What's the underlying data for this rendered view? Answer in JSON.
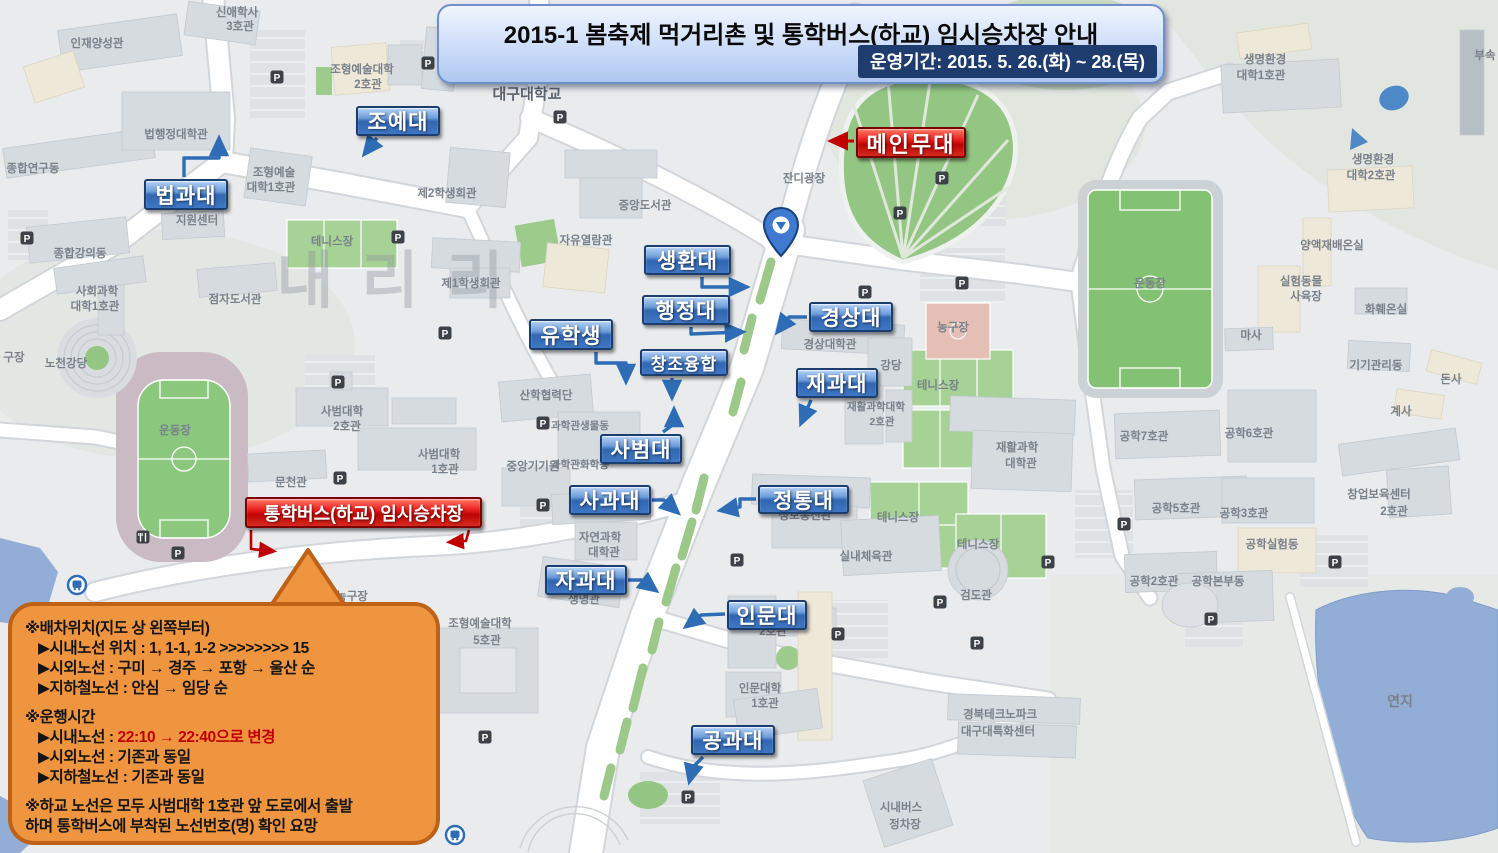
{
  "banner": {
    "title": "2015-1 봄축제 먹거리촌 및 통학버스(하교) 임시승차장 안내",
    "period": "운영기간: 2015. 5. 26.(화) ~ 28.(목)"
  },
  "stage": {
    "label": "메인무대",
    "arrow": [
      [
        854,
        141
      ],
      [
        833,
        141
      ]
    ]
  },
  "pickup": {
    "label": "통학버스(하교) 임시승차장",
    "arrows": [
      [
        [
          251,
          530
        ],
        [
          251,
          549
        ],
        [
          272,
          551
        ]
      ],
      [
        [
          469,
          530
        ],
        [
          466,
          541
        ],
        [
          451,
          542
        ]
      ]
    ]
  },
  "faculties": [
    {
      "label": "조예대",
      "x": 356,
      "y": 106,
      "w": 84,
      "h": 30,
      "arrow": [
        [
          377,
          138
        ],
        [
          366,
          152
        ]
      ]
    },
    {
      "label": "법과대",
      "x": 144,
      "y": 179,
      "w": 84,
      "h": 31,
      "arrow": [
        [
          184,
          177
        ],
        [
          184,
          158
        ],
        [
          219,
          158
        ],
        [
          219,
          141
        ]
      ]
    },
    {
      "label": "생환대",
      "x": 644,
      "y": 245,
      "w": 87,
      "h": 30,
      "arrow": [
        [
          702,
          277
        ],
        [
          702,
          287
        ],
        [
          744,
          287
        ]
      ]
    },
    {
      "label": "행정대",
      "x": 642,
      "y": 295,
      "w": 88,
      "h": 30,
      "arrow": [
        [
          691,
          327
        ],
        [
          691,
          334
        ],
        [
          740,
          332
        ]
      ]
    },
    {
      "label": "창조융합",
      "x": 640,
      "y": 349,
      "w": 88,
      "h": 27,
      "fs": 17,
      "arrow": [
        [
          672,
          378
        ],
        [
          672,
          395
        ]
      ]
    },
    {
      "label": "경상대",
      "x": 809,
      "y": 302,
      "w": 84,
      "h": 30,
      "arrow": [
        [
          807,
          317
        ],
        [
          789,
          317
        ],
        [
          779,
          330
        ]
      ]
    },
    {
      "label": "재과대",
      "x": 796,
      "y": 368,
      "w": 82,
      "h": 30,
      "arrow": [
        [
          811,
          400
        ],
        [
          802,
          421
        ]
      ]
    },
    {
      "label": "유학생",
      "x": 529,
      "y": 319,
      "w": 84,
      "h": 31,
      "arrow": [
        [
          596,
          352
        ],
        [
          596,
          363
        ],
        [
          626,
          363
        ],
        [
          626,
          379
        ]
      ]
    },
    {
      "label": "사범대",
      "x": 600,
      "y": 434,
      "w": 82,
      "h": 30,
      "arrow": [
        [
          663,
          432
        ],
        [
          674,
          424
        ],
        [
          674,
          412
        ]
      ]
    },
    {
      "label": "사과대",
      "x": 569,
      "y": 485,
      "w": 82,
      "h": 30,
      "arrow": [
        [
          652,
          500
        ],
        [
          664,
          500
        ],
        [
          676,
          511
        ]
      ]
    },
    {
      "label": "정통대",
      "x": 758,
      "y": 485,
      "w": 91,
      "h": 29,
      "arrow": [
        [
          756,
          499
        ],
        [
          740,
          499
        ],
        [
          740,
          507
        ],
        [
          723,
          510
        ]
      ]
    },
    {
      "label": "자과대",
      "x": 545,
      "y": 565,
      "w": 82,
      "h": 30,
      "arrow": [
        [
          628,
          580
        ],
        [
          642,
          580
        ],
        [
          654,
          589
        ]
      ]
    },
    {
      "label": "인문대",
      "x": 727,
      "y": 600,
      "w": 80,
      "h": 30,
      "arrow": [
        [
          725,
          614
        ],
        [
          701,
          615
        ],
        [
          688,
          625
        ]
      ]
    },
    {
      "label": "공과대",
      "x": 691,
      "y": 725,
      "w": 84,
      "h": 30,
      "arrow": [
        [
          703,
          757
        ],
        [
          693,
          767
        ],
        [
          690,
          779
        ]
      ]
    }
  ],
  "notice": {
    "lines": [
      {
        "indent": 0,
        "gap": false,
        "parts": [
          {
            "t": "※배차위치(지도 상 왼쪽부터)"
          }
        ]
      },
      {
        "indent": 1,
        "gap": false,
        "parts": [
          {
            "t": "▶시내노선 위치 : 1, 1-1, 1-2 >>>>>>>> 15"
          }
        ]
      },
      {
        "indent": 1,
        "gap": false,
        "parts": [
          {
            "t": "▶시외노선 : 구미 → 경주 → 포항 → 울산 순"
          }
        ]
      },
      {
        "indent": 1,
        "gap": false,
        "parts": [
          {
            "t": "▶지하철노선 : 안심 → 임당 순"
          }
        ]
      },
      {
        "indent": 0,
        "gap": true,
        "parts": [
          {
            "t": "※운행시간"
          }
        ]
      },
      {
        "indent": 1,
        "gap": false,
        "parts": [
          {
            "t": "▶시내노선 : "
          },
          {
            "t": "22:10 → 22:40으로 변경",
            "red": true
          }
        ]
      },
      {
        "indent": 1,
        "gap": false,
        "parts": [
          {
            "t": "▶시외노선 : 기존과 동일"
          }
        ]
      },
      {
        "indent": 1,
        "gap": false,
        "parts": [
          {
            "t": "▶지하철노선 : 기존과 동일"
          }
        ]
      },
      {
        "indent": 0,
        "gap": true,
        "parts": [
          {
            "t": "※하교 노선은 모두 사범대학 1호관 앞 도로에서 출발"
          }
        ]
      },
      {
        "indent": 0,
        "gap": false,
        "parts": [
          {
            "t": " 하며 통학버스에 부착된 노선번호(명) 확인 요망"
          }
        ]
      }
    ]
  },
  "map": {
    "watermark": "내리리",
    "parking_glyph": "P",
    "parking": [
      [
        27,
        238
      ],
      [
        277,
        77
      ],
      [
        428,
        63
      ],
      [
        398,
        237
      ],
      [
        445,
        333
      ],
      [
        338,
        382
      ],
      [
        340,
        478
      ],
      [
        543,
        423
      ],
      [
        543,
        505
      ],
      [
        560,
        117
      ],
      [
        942,
        178
      ],
      [
        900,
        213
      ],
      [
        865,
        292
      ],
      [
        962,
        283
      ],
      [
        737,
        560
      ],
      [
        838,
        634
      ],
      [
        688,
        797
      ],
      [
        485,
        737
      ],
      [
        1124,
        524
      ],
      [
        1048,
        562
      ],
      [
        1211,
        619
      ],
      [
        1335,
        562
      ],
      [
        977,
        643
      ],
      [
        940,
        602
      ],
      [
        178,
        553
      ]
    ],
    "transit": [
      [
        77,
        585
      ],
      [
        455,
        835
      ]
    ],
    "restaurant": [
      [
        143,
        537
      ]
    ],
    "places": [
      {
        "t": "대구대학교",
        "x": 527,
        "y": 99,
        "s": 15,
        "d": true
      },
      {
        "t": "인재양성관",
        "x": 97,
        "y": 47
      },
      {
        "t": "신애학사",
        "x": 237,
        "y": 16
      },
      {
        "t": "3호관",
        "x": 240,
        "y": 30
      },
      {
        "t": "종합연구동",
        "x": 33,
        "y": 172
      },
      {
        "t": "법행정대학관",
        "x": 176,
        "y": 138
      },
      {
        "t": "조형예술대학",
        "x": 362,
        "y": 73
      },
      {
        "t": "2호관",
        "x": 368,
        "y": 88
      },
      {
        "t": "조형예술",
        "x": 274,
        "y": 176
      },
      {
        "t": "대학1호관",
        "x": 271,
        "y": 191
      },
      {
        "t": "지원센터",
        "x": 197,
        "y": 224
      },
      {
        "t": "제2학생회관",
        "x": 447,
        "y": 197
      },
      {
        "t": "종합강의동",
        "x": 80,
        "y": 257
      },
      {
        "t": "테니스장",
        "x": 332,
        "y": 245
      },
      {
        "t": "사회과학",
        "x": 97,
        "y": 295
      },
      {
        "t": "대학1호관",
        "x": 95,
        "y": 310
      },
      {
        "t": "점자도서관",
        "x": 235,
        "y": 303
      },
      {
        "t": "노천강당",
        "x": 66,
        "y": 367
      },
      {
        "t": "구장",
        "x": 14,
        "y": 361
      },
      {
        "t": "운동장",
        "x": 175,
        "y": 434
      },
      {
        "t": "문천관",
        "x": 291,
        "y": 486
      },
      {
        "t": "사범대학",
        "x": 342,
        "y": 415
      },
      {
        "t": "2호관",
        "x": 347,
        "y": 430
      },
      {
        "t": "사범대학",
        "x": 439,
        "y": 458
      },
      {
        "t": "1호관",
        "x": 445,
        "y": 473
      },
      {
        "t": "중앙기기원",
        "x": 533,
        "y": 470
      },
      {
        "t": "산학협력단",
        "x": 546,
        "y": 399
      },
      {
        "t": "과학관생물동",
        "x": 580,
        "y": 429,
        "s": 10.5
      },
      {
        "t": "과학관화학동",
        "x": 580,
        "y": 468,
        "s": 10.5
      },
      {
        "t": "자연과학",
        "x": 600,
        "y": 541
      },
      {
        "t": "대학관",
        "x": 604,
        "y": 556
      },
      {
        "t": "생명관",
        "x": 584,
        "y": 603
      },
      {
        "t": "중앙도서관",
        "x": 645,
        "y": 209
      },
      {
        "t": "자유열람관",
        "x": 586,
        "y": 244
      },
      {
        "t": "제1학생회관",
        "x": 471,
        "y": 287
      },
      {
        "t": "잔디광장",
        "x": 804,
        "y": 182
      },
      {
        "t": "경상대학관",
        "x": 830,
        "y": 348
      },
      {
        "t": "강당",
        "x": 891,
        "y": 369
      },
      {
        "t": "농구장",
        "x": 953,
        "y": 331
      },
      {
        "t": "테니스장",
        "x": 938,
        "y": 389
      },
      {
        "t": "테니스장",
        "x": 898,
        "y": 521
      },
      {
        "t": "테니스장",
        "x": 978,
        "y": 548
      },
      {
        "t": "재활과학대학",
        "x": 876,
        "y": 410,
        "s": 10.5
      },
      {
        "t": "2호관",
        "x": 882,
        "y": 425,
        "s": 10.5
      },
      {
        "t": "재활과학",
        "x": 1017,
        "y": 451
      },
      {
        "t": "대학관",
        "x": 1021,
        "y": 467
      },
      {
        "t": "정보통신관",
        "x": 805,
        "y": 519
      },
      {
        "t": "실내체육관",
        "x": 866,
        "y": 560
      },
      {
        "t": "검도관",
        "x": 976,
        "y": 599
      },
      {
        "t": "2호관",
        "x": 773,
        "y": 635
      },
      {
        "t": "인문대학",
        "x": 760,
        "y": 692
      },
      {
        "t": "1호관",
        "x": 765,
        "y": 707
      },
      {
        "t": "경북테크노파크",
        "x": 1000,
        "y": 718
      },
      {
        "t": "대구대특화센터",
        "x": 998,
        "y": 735
      },
      {
        "t": "시내버스",
        "x": 901,
        "y": 811
      },
      {
        "t": "정차장",
        "x": 905,
        "y": 828
      },
      {
        "t": "조형예술대학",
        "x": 480,
        "y": 627
      },
      {
        "t": "5호관",
        "x": 487,
        "y": 644
      },
      {
        "t": "농구장",
        "x": 352,
        "y": 600
      },
      {
        "t": "생명환경",
        "x": 1265,
        "y": 63
      },
      {
        "t": "대학1호관",
        "x": 1261,
        "y": 79
      },
      {
        "t": "생명환경",
        "x": 1373,
        "y": 163
      },
      {
        "t": "대학2호관",
        "x": 1371,
        "y": 179
      },
      {
        "t": "양액재배온실",
        "x": 1332,
        "y": 249
      },
      {
        "t": "실험동물",
        "x": 1301,
        "y": 285
      },
      {
        "t": "사육장",
        "x": 1306,
        "y": 300
      },
      {
        "t": "부속",
        "x": 1485,
        "y": 59
      },
      {
        "t": "화훼온실",
        "x": 1386,
        "y": 313
      },
      {
        "t": "마사",
        "x": 1251,
        "y": 339
      },
      {
        "t": "기기관리동",
        "x": 1376,
        "y": 369
      },
      {
        "t": "돈사",
        "x": 1451,
        "y": 383
      },
      {
        "t": "계사",
        "x": 1401,
        "y": 415
      },
      {
        "t": "공학7호관",
        "x": 1144,
        "y": 440
      },
      {
        "t": "공학6호관",
        "x": 1249,
        "y": 437
      },
      {
        "t": "공학5호관",
        "x": 1176,
        "y": 512
      },
      {
        "t": "공학3호관",
        "x": 1244,
        "y": 517
      },
      {
        "t": "창업보육센터",
        "x": 1379,
        "y": 498
      },
      {
        "t": "2호관",
        "x": 1394,
        "y": 515
      },
      {
        "t": "공학실험동",
        "x": 1272,
        "y": 548
      },
      {
        "t": "공학2호관",
        "x": 1154,
        "y": 585
      },
      {
        "t": "공학본부동",
        "x": 1218,
        "y": 585
      },
      {
        "t": "운동장",
        "x": 1150,
        "y": 287
      },
      {
        "t": "연지",
        "x": 1400,
        "y": 706,
        "s": 14
      }
    ]
  },
  "colors": {
    "accent_blue": "#3166b0",
    "accent_red": "#c00000",
    "banner_blue": "#d3e1fa",
    "bubble_orange": "#f0953f",
    "water": "#93aed6",
    "grass": "#94c683"
  }
}
